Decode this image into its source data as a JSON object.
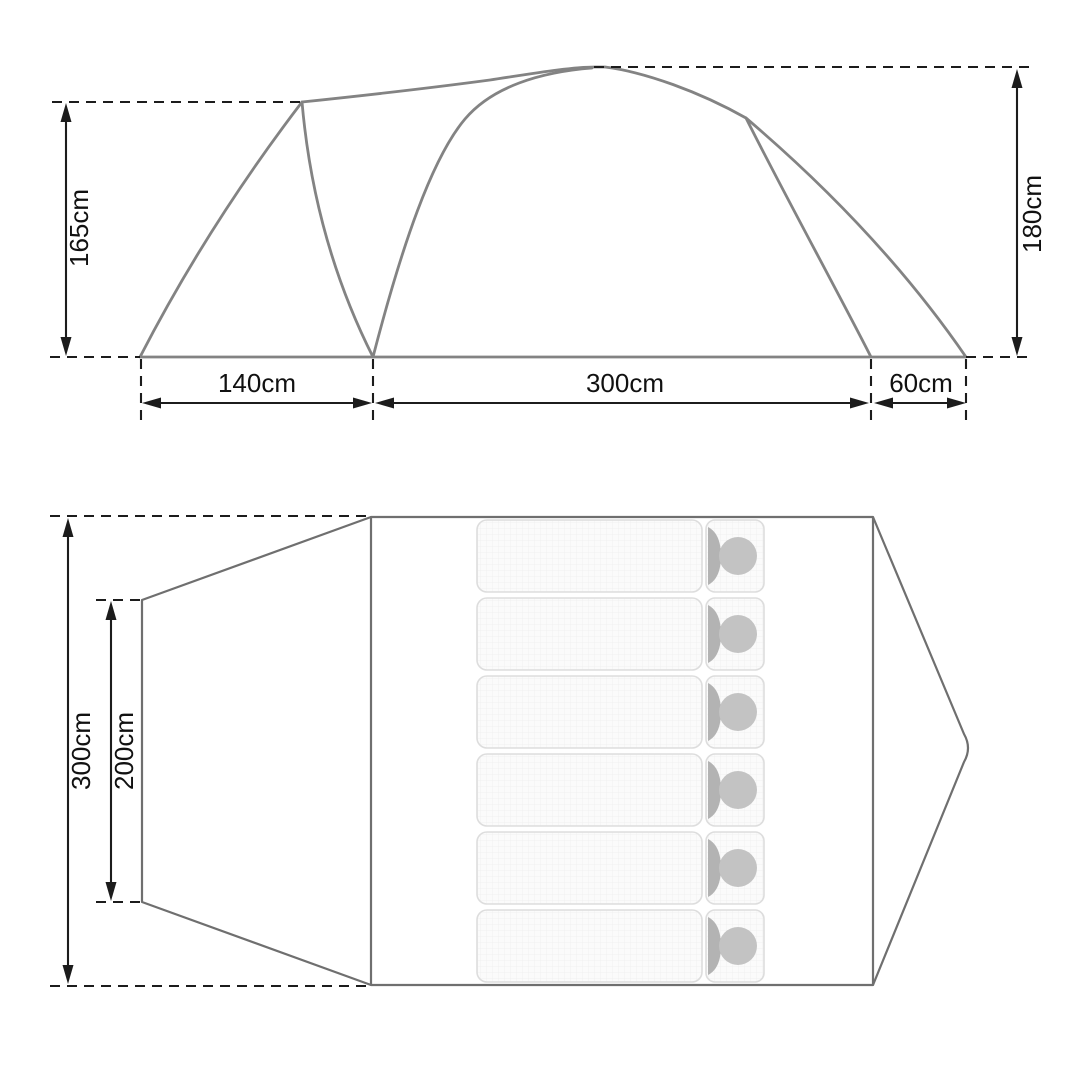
{
  "title": "Tent dimensions diagram",
  "side_view": {
    "height_left": "165cm",
    "height_right": "180cm",
    "width_front": "140cm",
    "width_main": "300cm",
    "width_rear": "60cm"
  },
  "floor_plan": {
    "depth_outer": "300cm",
    "depth_inner": "200cm",
    "sleeping_pads": 6
  },
  "colors": {
    "tent_fill": "#ededed",
    "tent_outline": "#838383",
    "plan_outline": "#6f6f6f",
    "dimension_ink": "#1c1c1c",
    "pad_fill": "#fbfbfb",
    "pad_border": "#dddddd",
    "hood": "#b3b3b3",
    "head": "#c3c3c3"
  }
}
